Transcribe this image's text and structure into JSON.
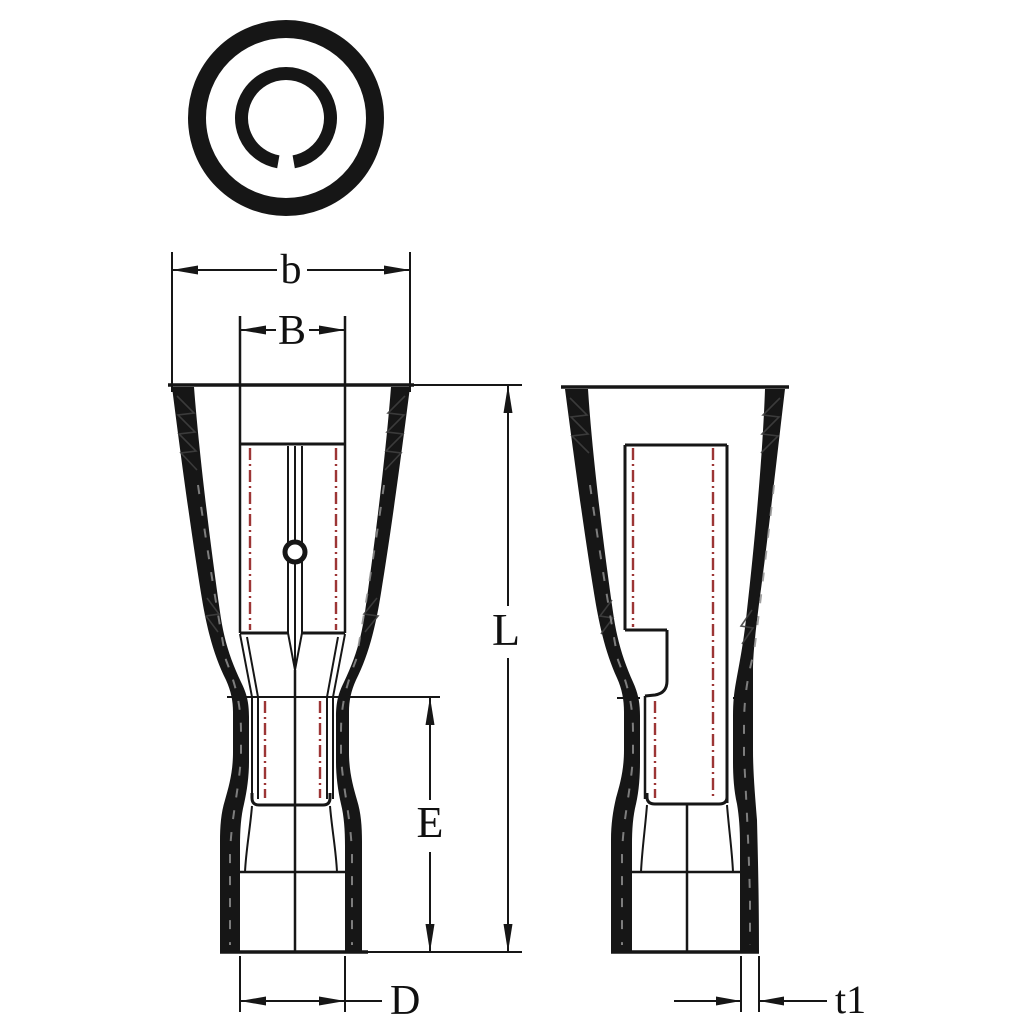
{
  "dims": {
    "b": "b",
    "B": "B",
    "L": "L",
    "E": "E",
    "D": "D",
    "t1": "t1"
  },
  "colors": {
    "background": "#ffffff",
    "line": "#161616",
    "hidden_line_red": "#9c3535",
    "wall_fill": "#161616",
    "hatch_gray": "#3f3f3f",
    "wall_dash_gray": "#8f8f8f"
  },
  "icons": {
    "top_view_rings": "concentric-rings-icon",
    "dimple": "dimple-circle-icon"
  }
}
